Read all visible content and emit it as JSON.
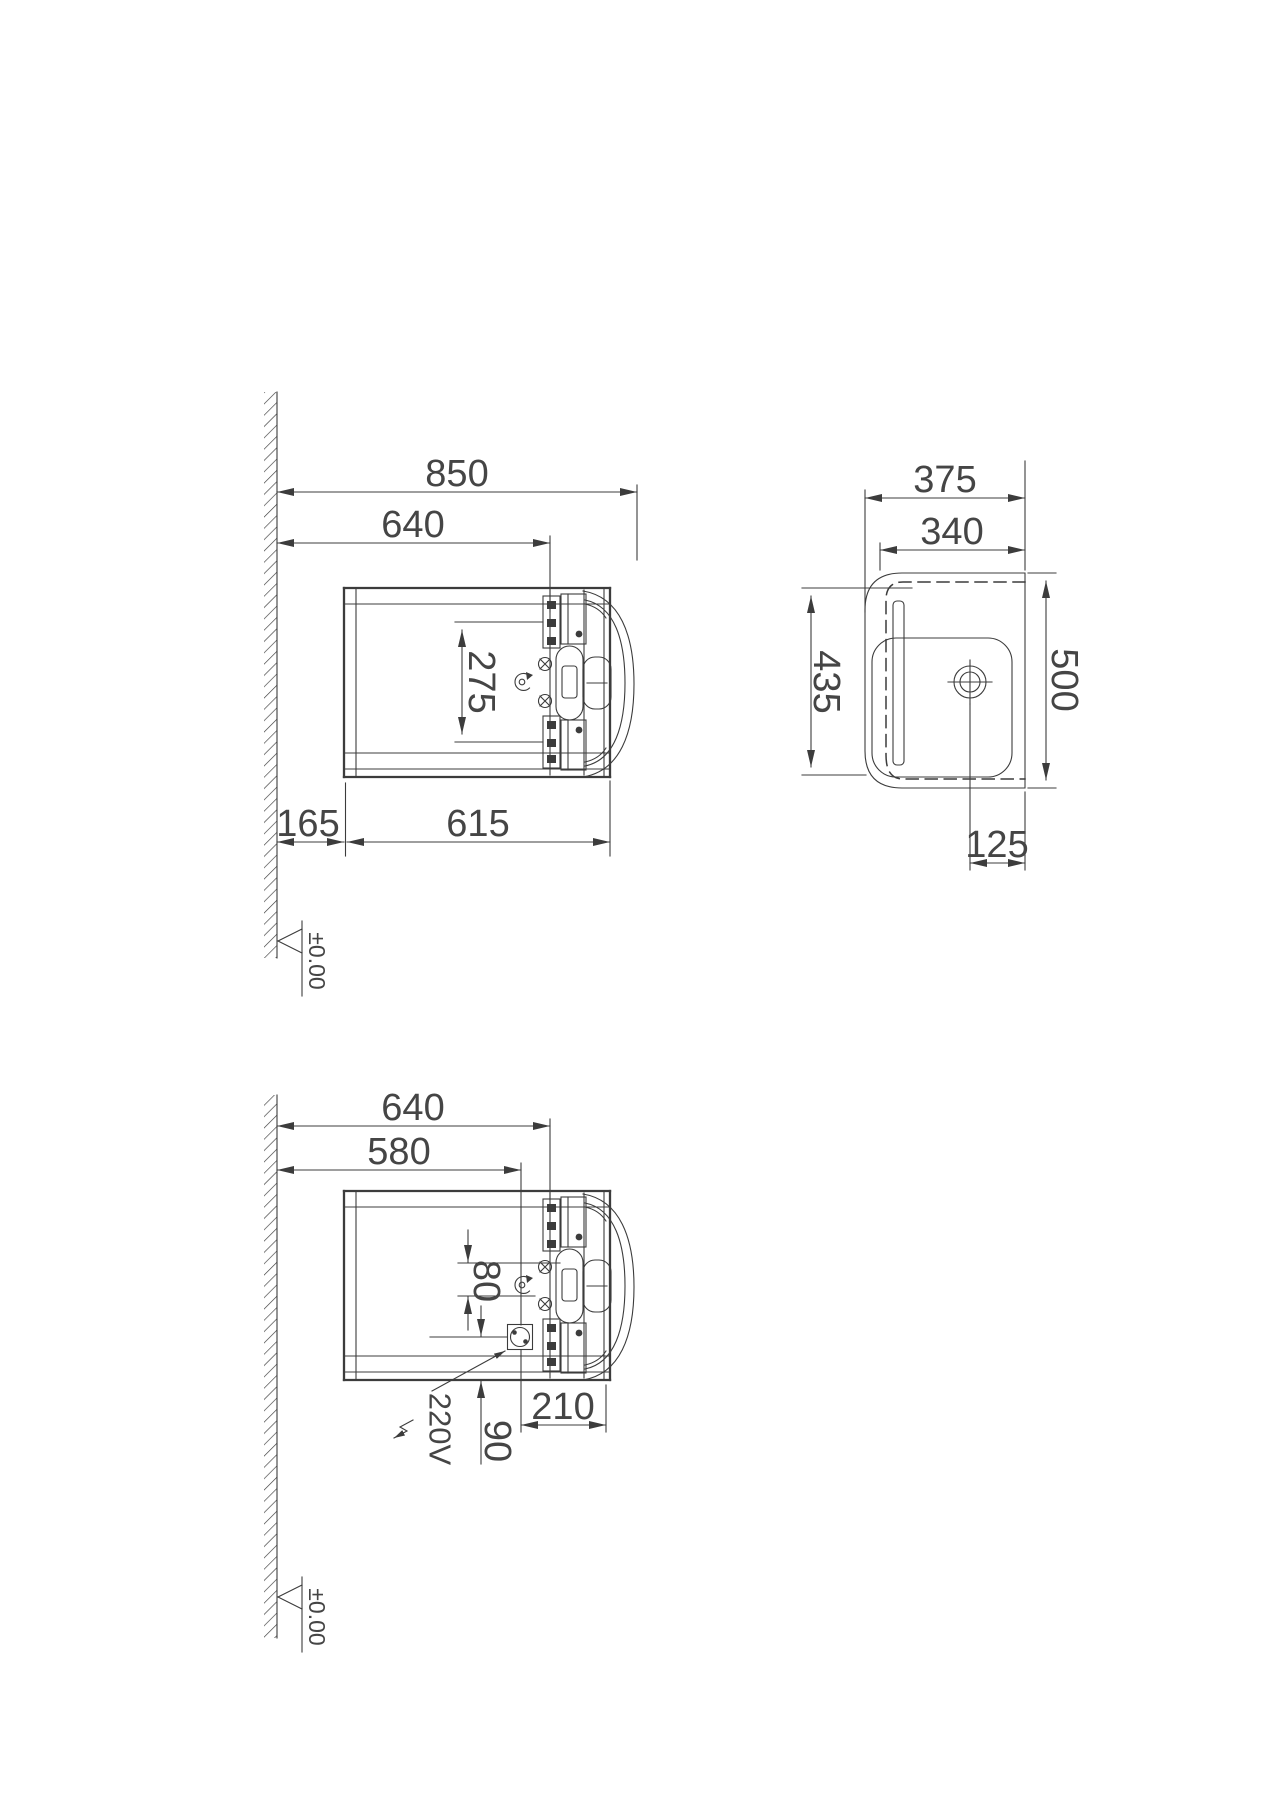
{
  "canvas": {
    "width": 1280,
    "height": 1817,
    "background": "#ffffff",
    "ink_color": "#3c3c3c"
  },
  "views": {
    "v1": {
      "name": "upper section view",
      "d850": "850",
      "d640": "640",
      "d275": "275",
      "d165": "165",
      "d615": "615",
      "level": "±0.00"
    },
    "v2": {
      "name": "plan view",
      "d375": "375",
      "d340": "340",
      "d435": "435",
      "d500": "500",
      "d125": "125"
    },
    "v3": {
      "name": "lower section view with electrical connection",
      "d640": "640",
      "d580": "580",
      "d80": "80",
      "d210": "210",
      "d90": "90",
      "volt": "220V",
      "level": "±0.00"
    }
  }
}
